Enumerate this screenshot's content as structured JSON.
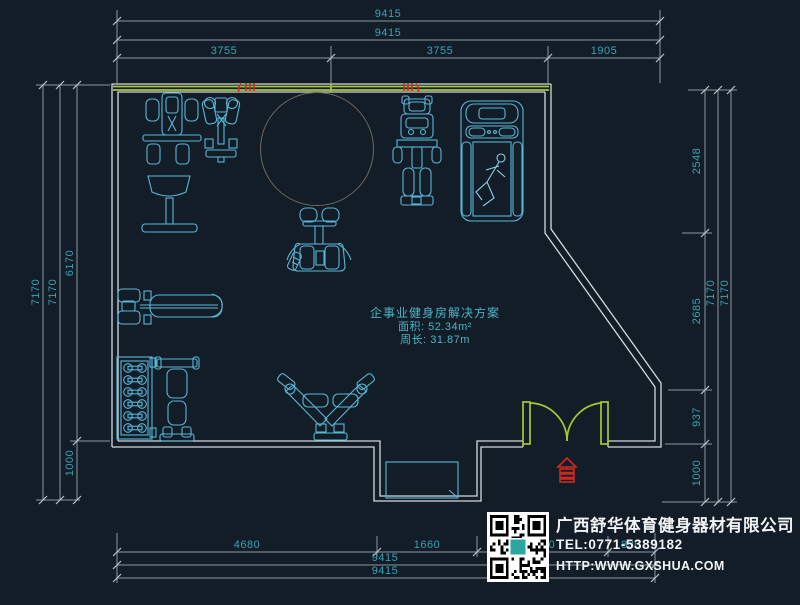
{
  "plan_note": {
    "title": "企事业健身房解决方案",
    "area": "面积: 52.34m²",
    "perimeter": "周长: 31.87m"
  },
  "dims": {
    "top_row1": "9415",
    "top_row2": "9415",
    "top_row3": [
      "3755",
      "3755",
      "1905"
    ],
    "bottom_row1": [
      "4680",
      "1660",
      "1500",
      "830"
    ],
    "bottom_row2": "9415",
    "bottom_row3": "9415",
    "left": [
      "7170",
      "7170",
      "6170",
      "1000"
    ],
    "right": [
      "2548",
      "2685",
      "937",
      "1000",
      "7170",
      "7170"
    ]
  },
  "company": {
    "name": "广西舒华体育健身器材有限公司",
    "tel": "TEL:0771-5389182",
    "web": "HTTP:WWW.GXSHUA.COM"
  },
  "equipment_icons": [
    "exercise-bike",
    "elliptical-trainer",
    "free-area-circle",
    "squat-machine",
    "multi-station-gym",
    "treadmill-with-runner",
    "bench-press",
    "dumbbell-rack",
    "adjustable-bench",
    "pec-deck-machine",
    "entry-platform",
    "double-door",
    "entrance-marker",
    "window-marks"
  ],
  "colors": {
    "bg": "#131d28",
    "wall": "#d4d9dc",
    "equip": "#58b6d6",
    "door": "#a6c832",
    "dim": "#8f96a0",
    "dim_text": "#3aa3b4",
    "red": "#cf2a20",
    "brand_text": "#f2f4f6",
    "qr_logo": "#2aa8a0",
    "circle": "#6f675f"
  }
}
